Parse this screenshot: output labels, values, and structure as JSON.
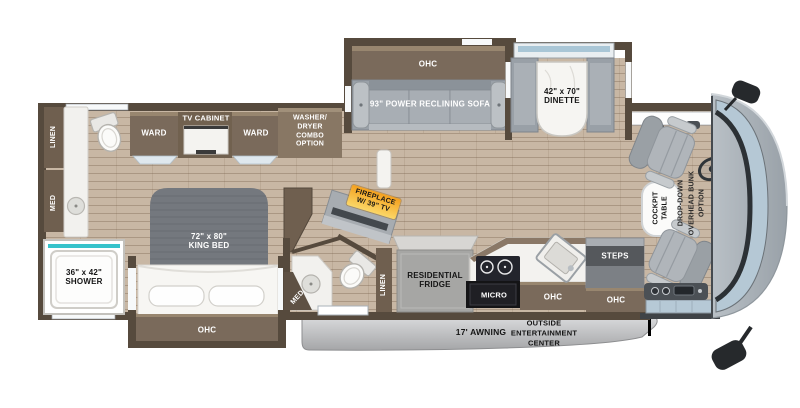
{
  "floorplan": {
    "type": "rv-motorhome-floorplan",
    "colors": {
      "wall_brown": "#564a3d",
      "cabinet_brown": "#7a6a5b",
      "floor_tan": "#c8b7a4",
      "sofa_gray": "#9aa1a8",
      "window_blue": "#a9c6d6",
      "shower_teal": "#36c3cb",
      "fireplace_orange": "#f4a01d",
      "awning_gray": "#c0c1c3",
      "cap_windshield": "#b5c8d5"
    },
    "labels": {
      "ohc_sofa": "OHC",
      "sofa": "93\" POWER RECLINING SOFA",
      "dinette": "42\" x 70\"\nDINETTE",
      "ward_left": "WARD",
      "tv_cabinet": "TV CABINET",
      "ward_right": "WARD",
      "washer_dryer": "WASHER/\nDRYER\nCOMBO\nOPTION",
      "linen_rear": "LINEN",
      "med_rear": "MED",
      "shower": "36\" x 42\"\nSHOWER",
      "king_bed": "72\" x 80\"\nKING BED",
      "ohc_bed": "OHC",
      "fireplace": "FIREPLACE\nW/ 39\" TV",
      "med_mid_bath": "MED",
      "linen_mid_bath": "LINEN",
      "fridge": "RESIDENTIAL\nFRIDGE",
      "micro": "MICRO",
      "ohc_kitchen": "OHC",
      "steps": "STEPS",
      "ohc_entry": "OHC",
      "awning": "17' AWNING",
      "outside_entertainment": "OUTSIDE\nENTERTAINMENT\nCENTER",
      "cockpit_table": "COCKPIT\nTABLE",
      "overhead_bunk": "DROP-DOWN\nOVERHEAD BUNK\nOPTION"
    }
  }
}
